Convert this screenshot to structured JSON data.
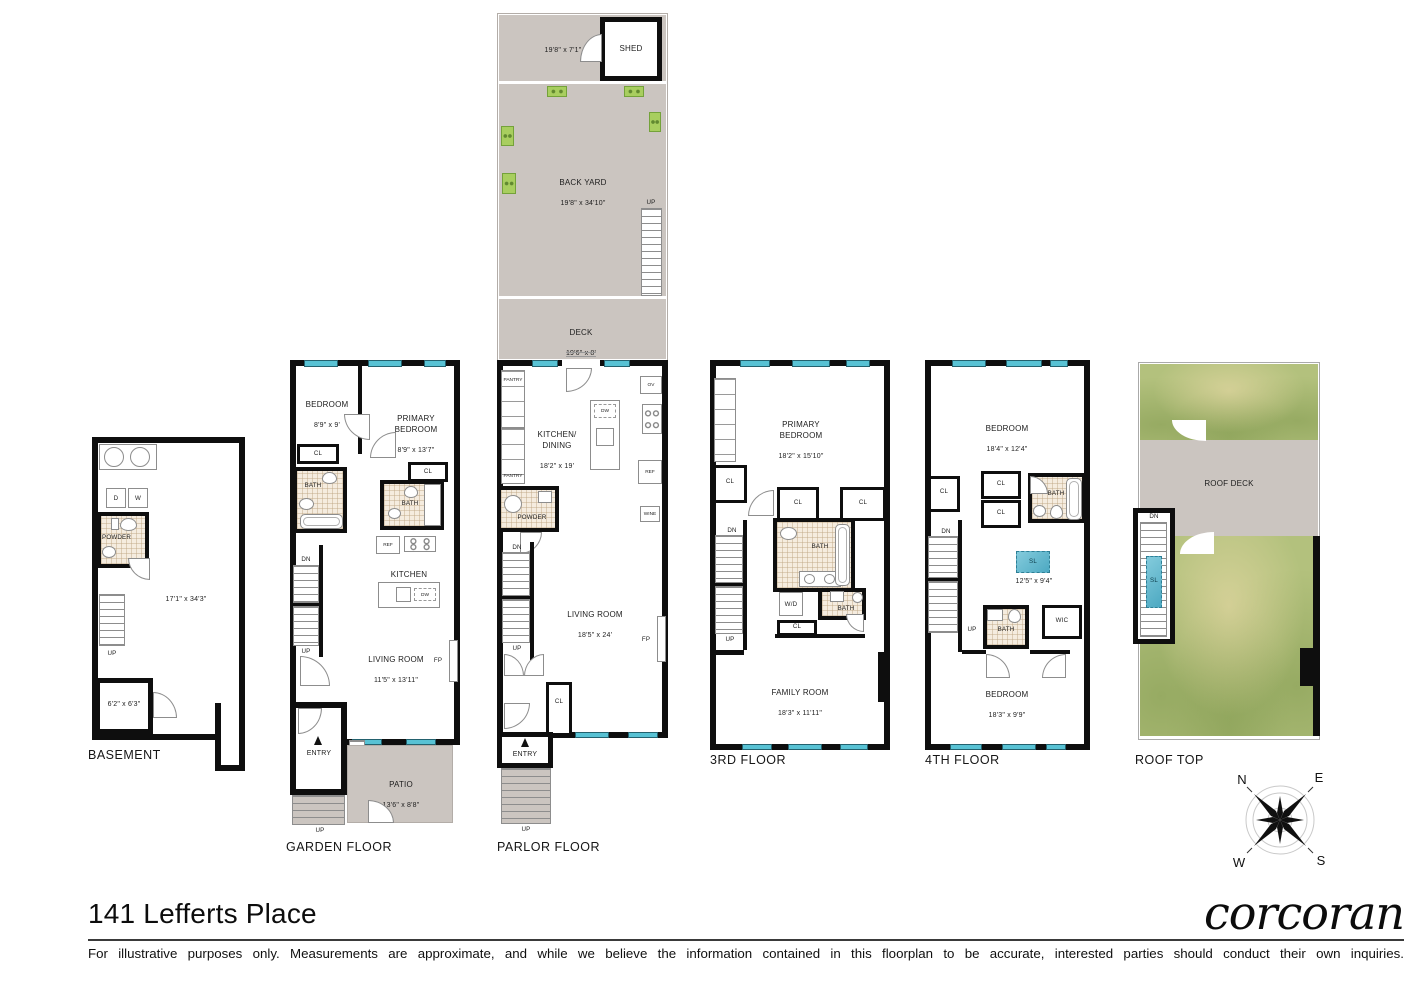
{
  "meta": {
    "title": "141 Lefferts Place",
    "brand": "corcoran",
    "disclaimer": "For illustrative purposes only.  Measurements are approximate, and while we believe the information contained in this floorplan to be accurate, interested parties should conduct their own inquiries."
  },
  "compass": {
    "n": "N",
    "e": "E",
    "w": "W",
    "s": "S"
  },
  "common": {
    "up": "UP",
    "dn": "DN",
    "cl": "CL",
    "entry": "ENTRY",
    "bath": "BATH",
    "powder": "POWDER",
    "sl": "SL",
    "wic": "WIC",
    "wd": "W/D",
    "ref": "REF",
    "dw": "DW",
    "fp": "FP",
    "ov": "OV",
    "wine": "WINE",
    "pantry": "PANTRY",
    "shed": "SHED",
    "d": "D",
    "w": "W"
  },
  "outdoor": {
    "shed_dims": "19'8\" x 7'1\"",
    "backyard": {
      "name": "BACK YARD",
      "dims": "19'8\" x 34'10\""
    },
    "deck": {
      "name": "DECK",
      "dims": "19'6\" x 8'"
    },
    "patio": {
      "name": "PATIO",
      "dims": "13'6\" x 8'8\""
    },
    "roofdeck": "ROOF DECK"
  },
  "basement": {
    "label": "BASEMENT",
    "main_dims": "17'1\" x 34'3\"",
    "storage_dims": "6'2\" x 6'3\""
  },
  "garden": {
    "label": "GARDEN FLOOR",
    "bedroom": {
      "name": "BEDROOM",
      "dims": "8'9\" x 9'"
    },
    "primary": {
      "name": "PRIMARY\nBEDROOM",
      "dims": "8'9\" x 13'7\""
    },
    "kitchen": {
      "name": "KITCHEN",
      "dims": "8'3\" x 8'9\""
    },
    "living": {
      "name": "LIVING ROOM",
      "dims": "11'5\" x 13'11\""
    }
  },
  "parlor": {
    "label": "PARLOR FLOOR",
    "kitchen": {
      "name": "KITCHEN/\nDINING",
      "dims": "18'2\" x 19'"
    },
    "living": {
      "name": "LIVING ROOM",
      "dims": "18'5\" x 24'"
    }
  },
  "third": {
    "label": "3RD FLOOR",
    "primary": {
      "name": "PRIMARY\nBEDROOM",
      "dims": "18'2\" x 15'10\""
    },
    "family": {
      "name": "FAMILY ROOM",
      "dims": "18'3\" x 11'11\""
    }
  },
  "fourth": {
    "label": "4TH FLOOR",
    "bedroom_top": {
      "name": "BEDROOM",
      "dims": "18'4\" x 12'4\""
    },
    "sky_dims": "12'5\" x 9'4\"",
    "bedroom_bottom": {
      "name": "BEDROOM",
      "dims": "18'3\" x 9'9\""
    }
  },
  "roof": {
    "label": "ROOF TOP"
  }
}
